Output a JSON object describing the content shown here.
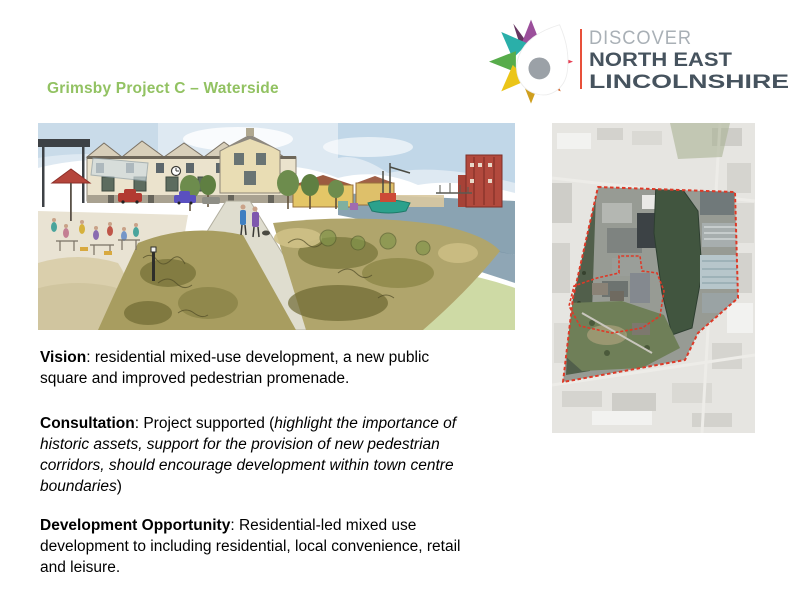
{
  "slide": {
    "title": "Grimsby Project C – Waterside",
    "title_color": "#92c262",
    "background_color": "#ffffff"
  },
  "logo": {
    "line1": "DISCOVER",
    "line2": "NORTH EAST",
    "line3": "LINCOLNSHIRE",
    "divider_color": "#e8503a",
    "muted_text_color": "#a9b0b6",
    "dark_text_color": "#46535e",
    "star_colors": [
      "#9b4f9b",
      "#663561",
      "#e63c50",
      "#d26227",
      "#cf9f1e",
      "#ebc518",
      "#57ac4b",
      "#2aafa9"
    ],
    "star_center_color": "#9ba1a7"
  },
  "map": {
    "boundary_color": "#dd3a28"
  },
  "paragraphs": {
    "vision": {
      "line1_bold": "Vision",
      "line1_rest": ": residential mixed-use development, a new public",
      "line2": "square and improved pedestrian promenade."
    },
    "consultation": {
      "line1_bold": "Consultation",
      "line1_rest": ": Project supported (",
      "line1_italic": "highlight the importance of",
      "line2_italic": "historic assets, support for the provision of new pedestrian",
      "line3_italic": "corridors, should encourage development within town centre",
      "line4_italic": "boundaries",
      "line4_rest": ")"
    },
    "development": {
      "line1_bold": "Development Opportunity",
      "line1_rest": ": Residential-led mixed use",
      "line2": "development to including residential, local convenience, retail",
      "line3": "and leisure."
    }
  }
}
